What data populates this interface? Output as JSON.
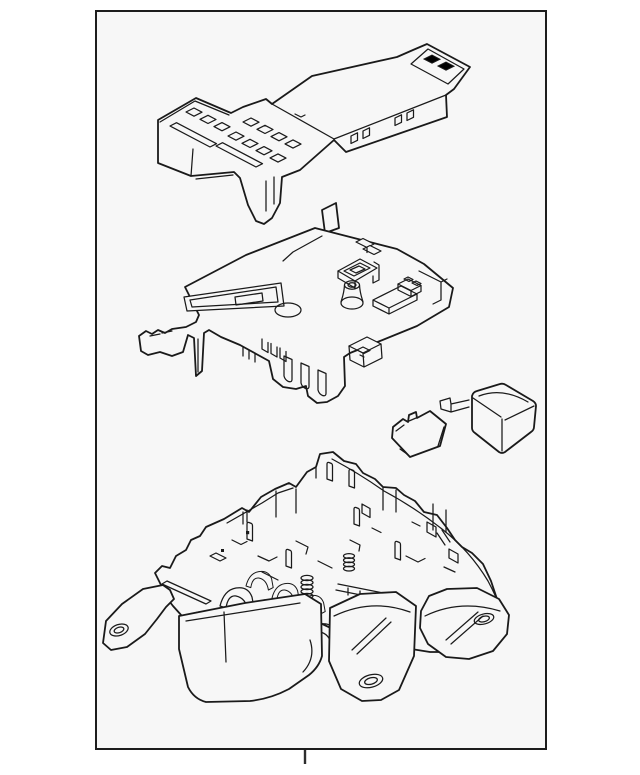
{
  "meta": {
    "width": 640,
    "height": 775
  },
  "css_vars": {
    "--page-bg": "#ffffff",
    "--frame-bg": "#f7f7f7",
    "--line": "#1a1a1a",
    "--frame-border": "#1d1d1d",
    "--tick-color": "#2e2e2e"
  },
  "frame": {
    "x": 96,
    "y": 11,
    "width": 450,
    "height": 738,
    "border_width": 2
  },
  "drawing": {
    "kind": "exploded-parts-line-art",
    "stroke_color": "#1a1a1a",
    "parts": [
      {
        "id": "upper-cover"
      },
      {
        "id": "fuse-block-body"
      },
      {
        "id": "mini-fuse"
      },
      {
        "id": "relay"
      },
      {
        "id": "lower-housing"
      }
    ]
  },
  "bottom_tick": {
    "x1": 305,
    "y1": 750,
    "x2": 305,
    "y2": 764
  }
}
